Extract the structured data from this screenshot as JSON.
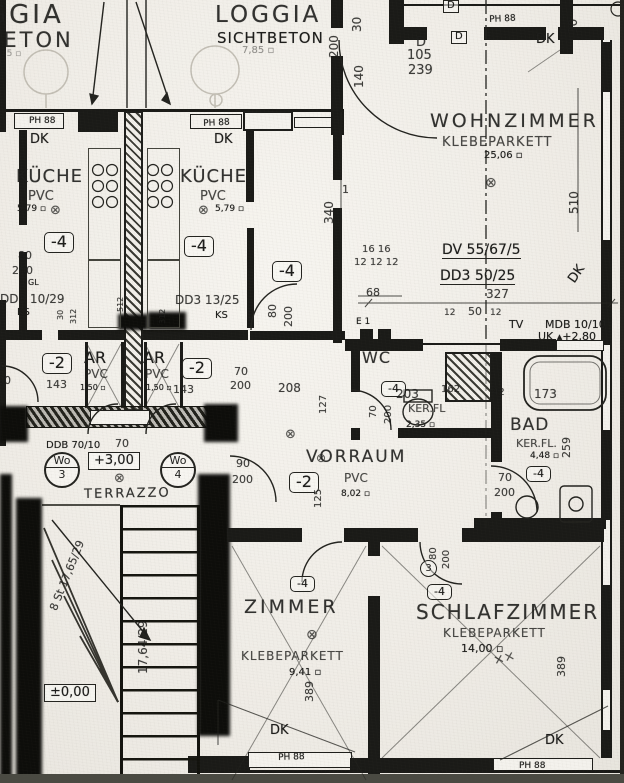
{
  "meta": {
    "paper_color": "#f0ede7",
    "ink_color": "#1d1d1b",
    "drawing_type": "floor plan scan"
  },
  "rooms": {
    "loggia": {
      "name": "LOGGIA",
      "finish": "SICHTBETON",
      "area": "7,85 ▫"
    },
    "loggia_cut": {
      "name": "GGIA",
      "finish": "BETON",
      "area": "3,5 ▫"
    },
    "wohnzimmer": {
      "name": "WOHNZIMMER",
      "finish": "KLEBEPARKETT",
      "area": "25,06 ▫"
    },
    "kueche": {
      "name": "KÜCHE",
      "finish": "PVC",
      "area": "5,79 ▫"
    },
    "ar": {
      "name": "AR",
      "finish": "PVC",
      "area": "1,50 ▫"
    },
    "wc": {
      "name": "WC",
      "finish": "KER.FL",
      "area": "2,35 ▫"
    },
    "bad": {
      "name": "BAD",
      "finish": "KER.FL.",
      "area": "4,48 ▫"
    },
    "vorraum": {
      "name": "VORRAUM",
      "finish": "PVC",
      "area": "8,02 ▫"
    },
    "zimmer": {
      "name": "ZIMMER",
      "finish": "KLEBEPARKETT",
      "area": "9,41 ▫"
    },
    "schlafzimmer": {
      "name": "SCHLAFZIMMER",
      "finish": "KLEBEPARKETT",
      "area": "14,00 ▫"
    },
    "terrazzo": {
      "name": "TERRAZZO"
    }
  },
  "tags": {
    "m4": "-4",
    "m2": "-2"
  },
  "labels": {
    "dk": "DK",
    "ph88": "PH 88",
    "ks": "KS",
    "gl": "GL",
    "tv": "TV",
    "e1": "E 1",
    "wo": "Wo",
    "no3": "3",
    "no4": "4",
    "circ3": "3",
    "d": "D"
  },
  "beams": {
    "dv": "DV 55/67/5",
    "dd3_50": "DD3 50/25",
    "dd3_10": "DD3 10/29",
    "dd3_13": "DD3 13/25",
    "ddb": "DDB 70/10",
    "mdb": "MDB 10/10",
    "uk": "UK ▴+2,80"
  },
  "levels": {
    "up": "+3,00",
    "zero": "±0,00"
  },
  "stairs": {
    "flight_winder": "8 St 17,65/29",
    "flight_straight": "17,64/29"
  },
  "symbols": {
    "outlet": "⊗",
    "cross": "××"
  },
  "dims": {
    "d30": "30",
    "d200": "200",
    "d140": "140",
    "d340": "340",
    "d510": "510",
    "d105": "105",
    "d239": "239",
    "d1": "1",
    "d16_16": "16 16",
    "d12_12_12": "12 12 12",
    "d68": "68",
    "d327": "327",
    "d12": "12",
    "d50": "50",
    "d80": "80",
    "d90": "90",
    "d70": "70",
    "d143": "143",
    "d208": "208",
    "d127": "127",
    "d203": "203",
    "d162": "162",
    "d42": "42",
    "d173": "173",
    "d259": "259",
    "d125": "125",
    "d389": "389",
    "d312": "312",
    "d512": "512"
  }
}
